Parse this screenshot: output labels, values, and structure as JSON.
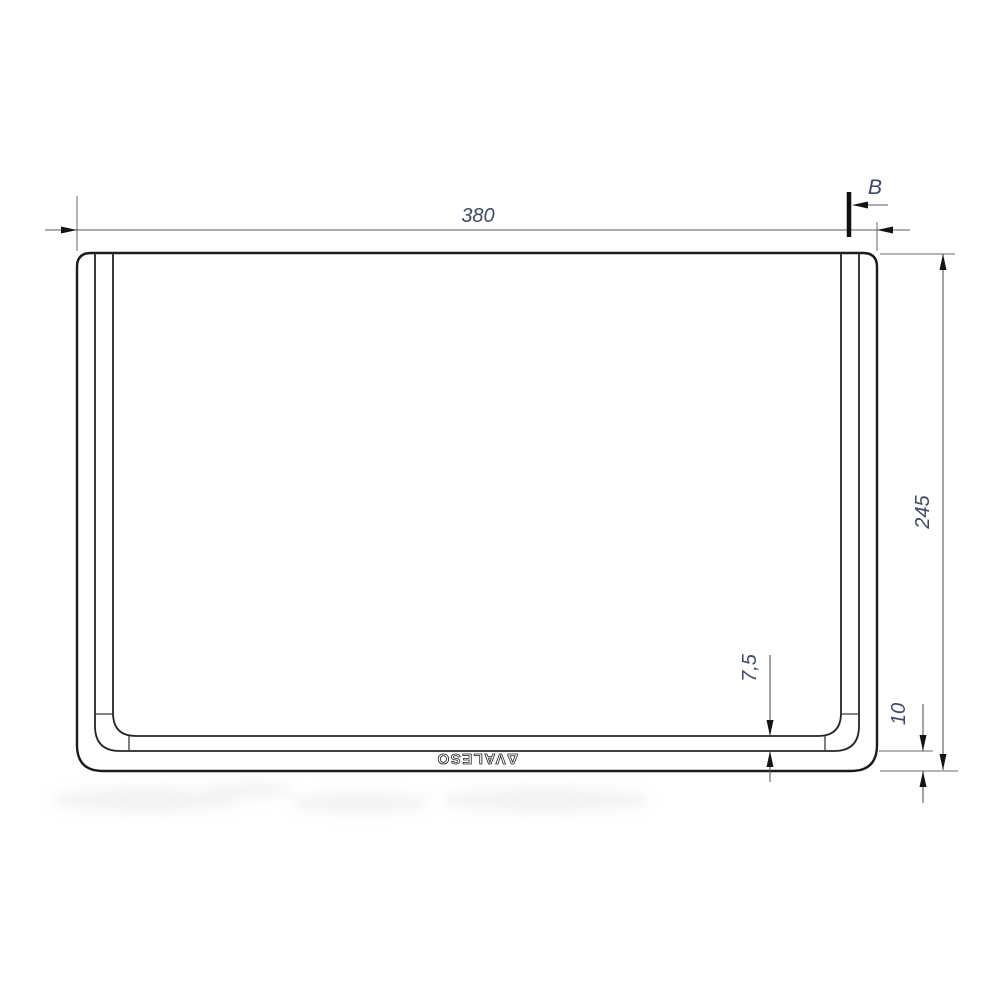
{
  "drawing": {
    "title": "tray-front-view-technical-drawing",
    "labels": {
      "width_dim": "380",
      "height_dim": "245",
      "rim_depth_dim": "7,5",
      "base_height_dim": "10",
      "section_mark": "B",
      "logo": "ΔVALESO"
    },
    "colors": {
      "part_edge": "#1b1b1b",
      "dimension_line": "#585858",
      "dimension_text": "#3d4966",
      "logo_stroke": "#222222",
      "background": "#ffffff"
    }
  }
}
